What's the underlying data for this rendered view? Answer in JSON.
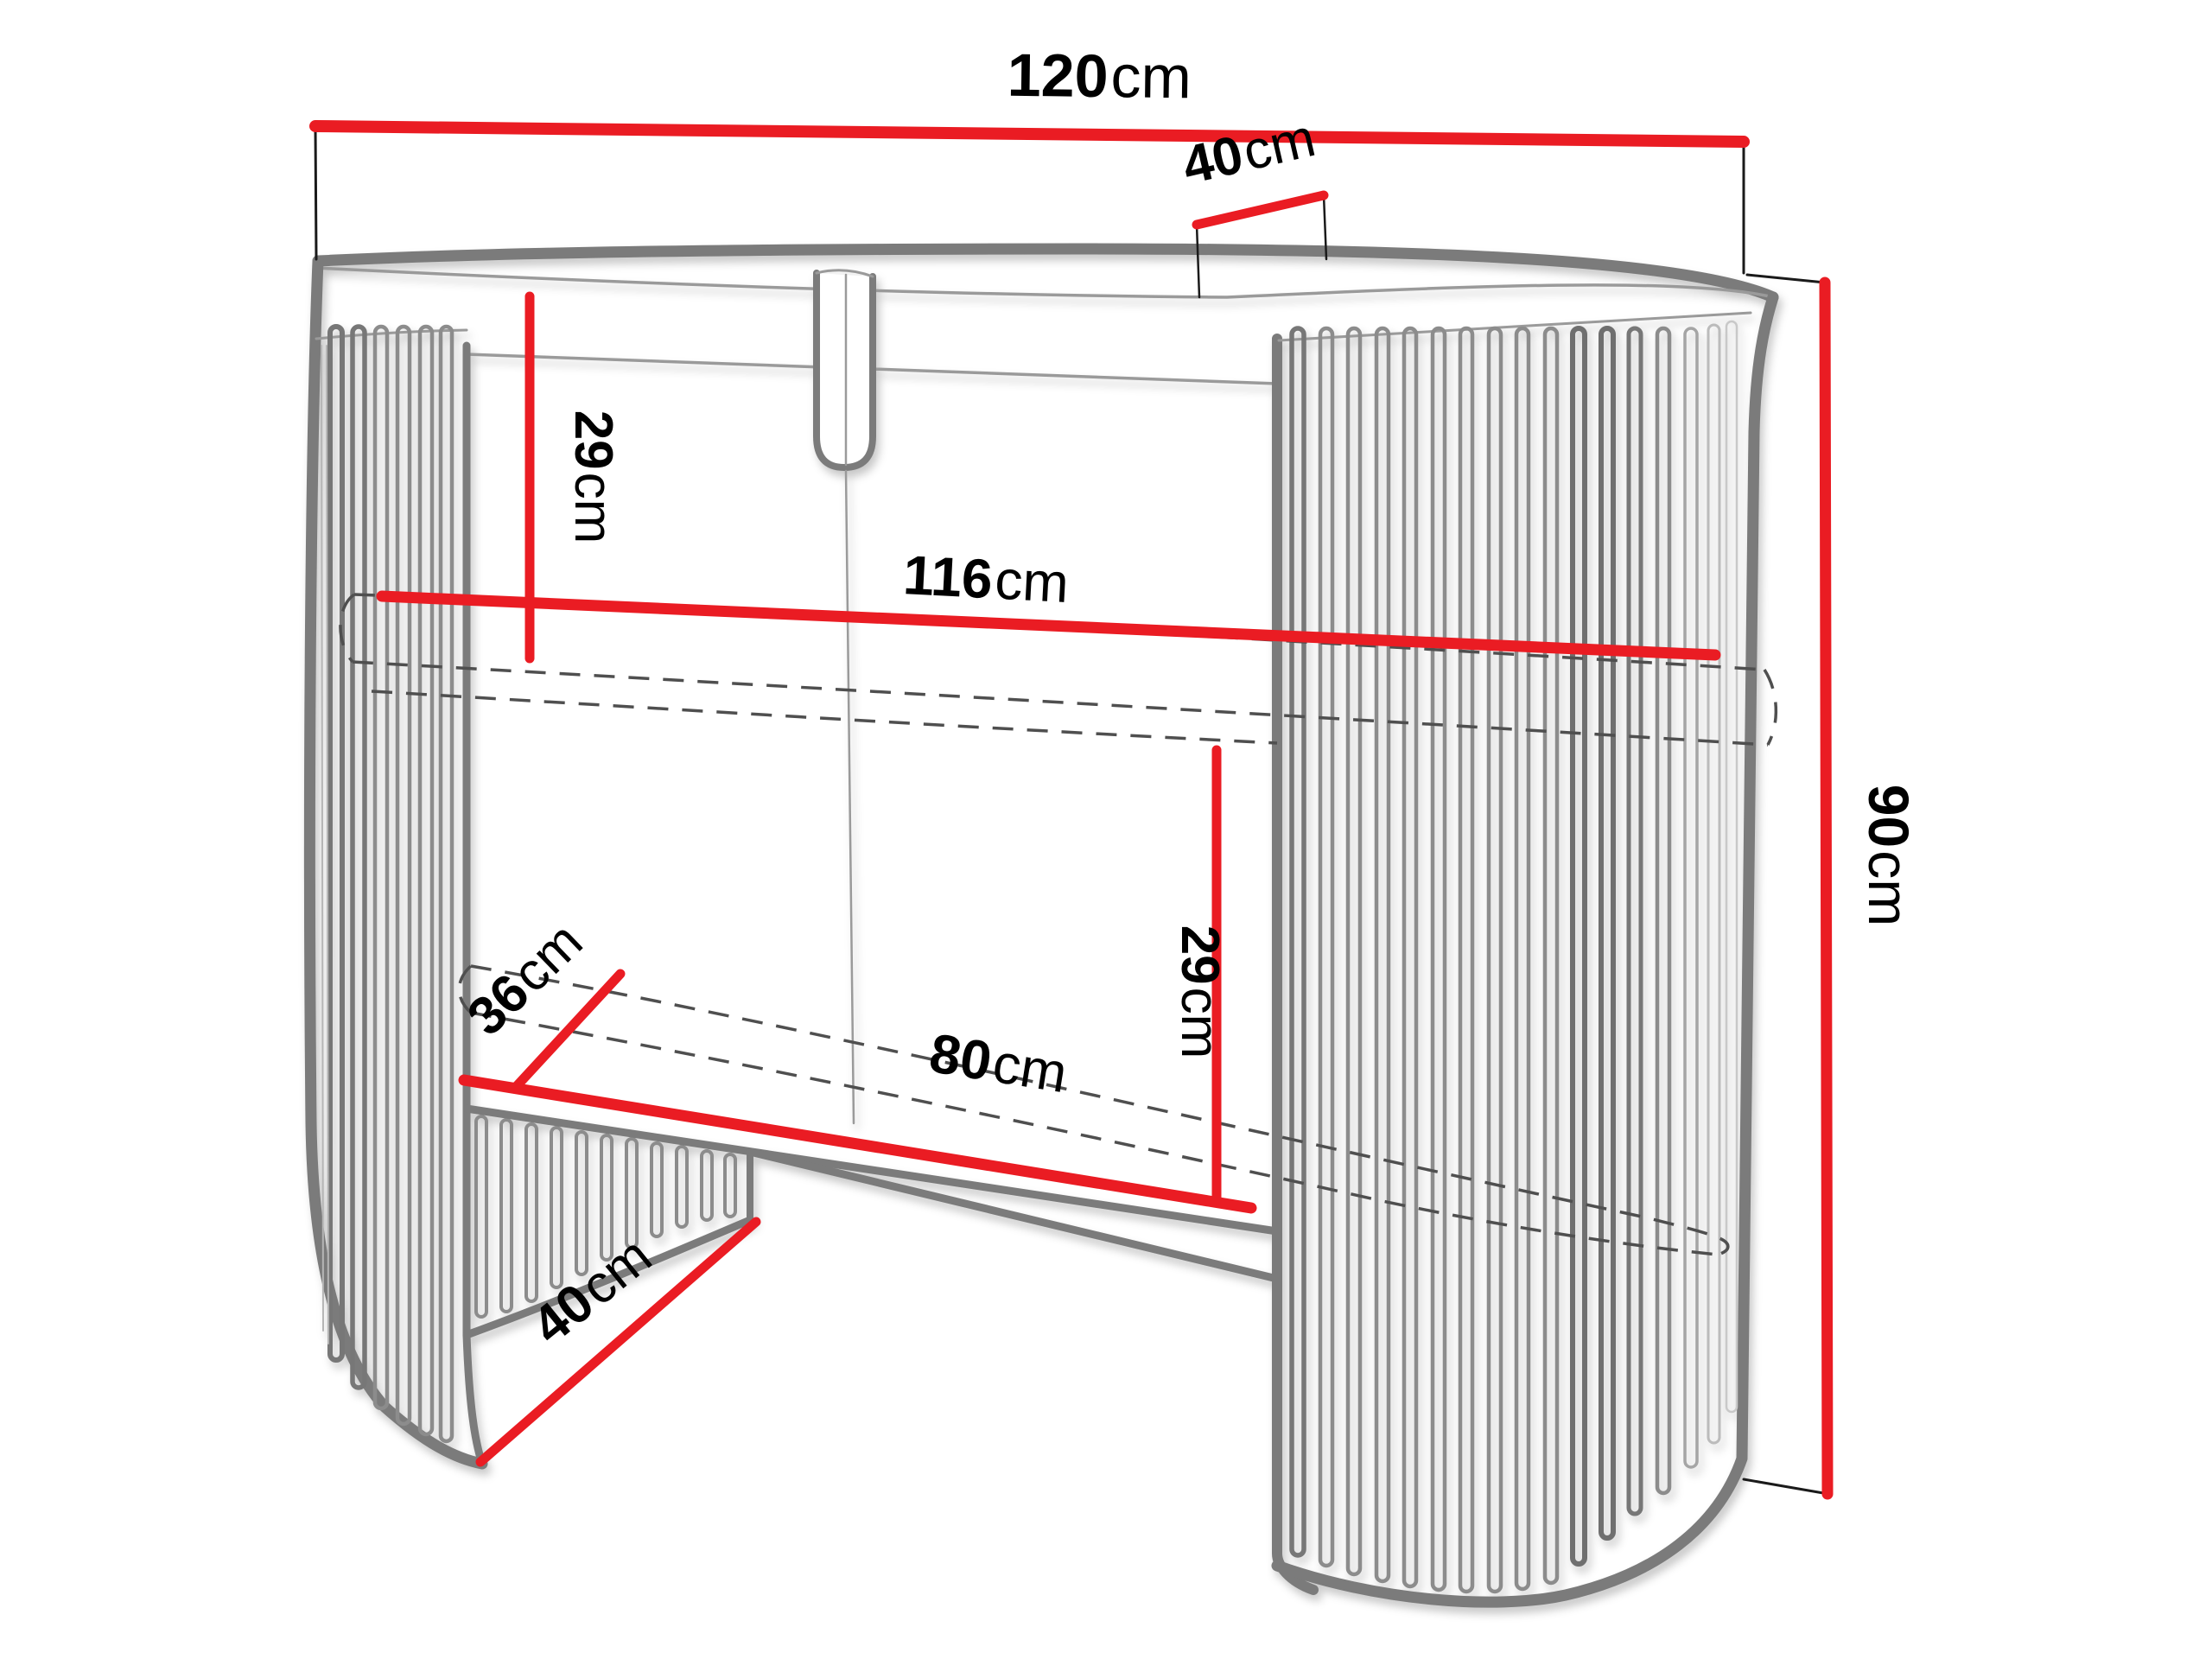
{
  "diagram": {
    "type": "furniture-dimension-diagram",
    "subject": "oval console table with slatted curved pedestals",
    "background": "#ffffff",
    "unit": "cm",
    "colors": {
      "dimension_line": "#EA1C23",
      "outline_gray": "#7b7b7b",
      "slat_gray": "#8c8c8c",
      "hidden_line": "#4f4f4f",
      "extension_line": "#1a1a1a",
      "label_text": "#000000"
    },
    "dimensions": {
      "top_width": {
        "value": "120",
        "unit": "cm"
      },
      "top_depth": {
        "value": "40",
        "unit": "cm"
      },
      "upper_shelf_clearance": {
        "value": "29",
        "unit": "cm"
      },
      "inner_width": {
        "value": "116",
        "unit": "cm"
      },
      "total_height": {
        "value": "90",
        "unit": "cm"
      },
      "arch_depth": {
        "value": "36",
        "unit": "cm"
      },
      "lower_shelf_clearance": {
        "value": "29",
        "unit": "cm"
      },
      "kneehole_width": {
        "value": "80",
        "unit": "cm"
      },
      "base_opening": {
        "value": "40",
        "unit": "cm"
      }
    }
  }
}
